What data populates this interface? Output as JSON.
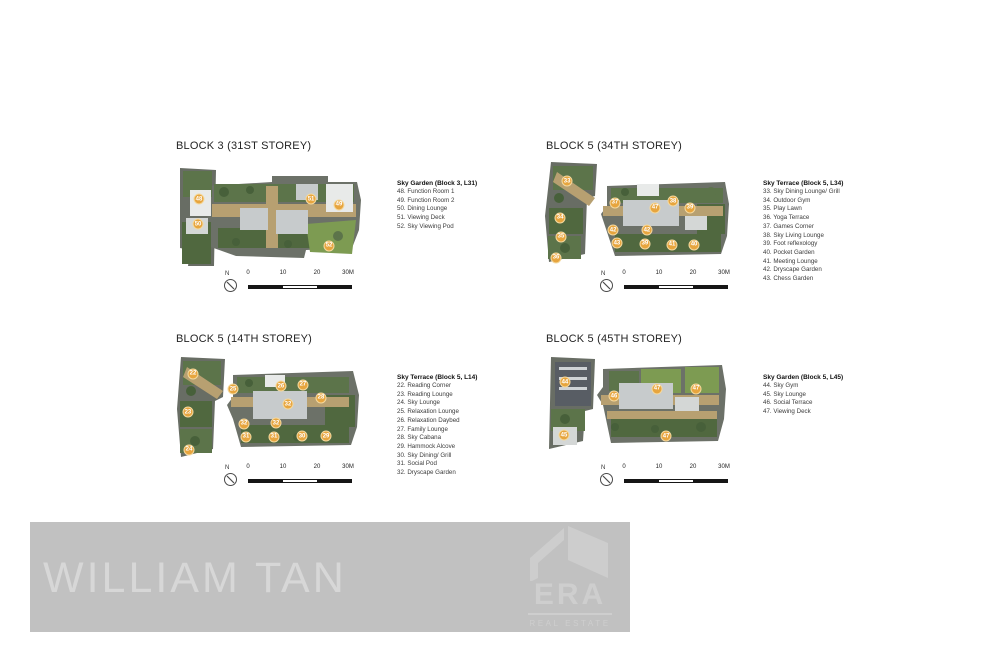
{
  "panels": [
    {
      "id": "block3-l31",
      "heading": "BLOCK 3 (31ST STOREY)",
      "legend_title": "Sky Garden (Block 3, L31)",
      "legend_items": [
        "48. Function Room 1",
        "49. Function Room 2",
        "50. Dining Lounge",
        "51. Viewing Deck",
        "52. Sky Viewing Pod"
      ],
      "markers": [
        {
          "label": "48",
          "x": 11.4,
          "y": 32.4
        },
        {
          "label": "50",
          "x": 10.9,
          "y": 56.9
        },
        {
          "label": "51",
          "x": 72.3,
          "y": 32.4
        },
        {
          "label": "49",
          "x": 87.5,
          "y": 38.2
        },
        {
          "label": "52",
          "x": 82.1,
          "y": 78.4
        }
      ]
    },
    {
      "id": "block5-l34",
      "heading": "BLOCK 5 (34TH STOREY)",
      "legend_title": "Sky Terrace (Block 5, L34)",
      "legend_items": [
        "33. Sky Dining Lounge/ Grill",
        "34. Outdoor Gym",
        "35. Play Lawn",
        "36. Yoga Terrace",
        "37. Games Corner",
        "38. Sky Living Lounge",
        "39. Foot reflexology",
        "40. Pocket Garden",
        "41. Meeting Lounge",
        "42. Dryscape Garden",
        "43. Chess Garden"
      ],
      "markers": [
        {
          "label": "33",
          "x": 12.0,
          "y": 18.3
        },
        {
          "label": "34",
          "x": 8.2,
          "y": 53.8
        },
        {
          "label": "35",
          "x": 8.7,
          "y": 72.1
        },
        {
          "label": "36",
          "x": 6.0,
          "y": 92.3
        },
        {
          "label": "37",
          "x": 38.0,
          "y": 39.4
        },
        {
          "label": "47",
          "x": 59.8,
          "y": 44.2
        },
        {
          "label": "38",
          "x": 69.6,
          "y": 37.5
        },
        {
          "label": "39",
          "x": 78.8,
          "y": 44.2
        },
        {
          "label": "42",
          "x": 37.0,
          "y": 65.4
        },
        {
          "label": "42",
          "x": 55.4,
          "y": 65.4
        },
        {
          "label": "43",
          "x": 39.1,
          "y": 77.9
        },
        {
          "label": "39",
          "x": 54.3,
          "y": 78.8
        },
        {
          "label": "41",
          "x": 69.0,
          "y": 79.8
        },
        {
          "label": "40",
          "x": 81.0,
          "y": 79.8
        }
      ]
    },
    {
      "id": "block5-l14",
      "heading": "BLOCK 5 (14TH STOREY)",
      "legend_title": "Sky Terrace (Block 5, L14)",
      "legend_items": [
        "22. Reading Corner",
        "23. Reading Lounge",
        "24. Sky Lounge",
        "25. Relaxation Lounge",
        "26. Relaxation Daybed",
        "27. Family Lounge",
        "28. Sky Cabana",
        "29. Hammock Alcove",
        "30. Sky Dining/ Grill",
        "31. Social Pod",
        "32. Dryscape Garden"
      ],
      "markers": [
        {
          "label": "22",
          "x": 8.8,
          "y": 16.3
        },
        {
          "label": "25",
          "x": 30.8,
          "y": 30.8
        },
        {
          "label": "26",
          "x": 57.1,
          "y": 27.9
        },
        {
          "label": "27",
          "x": 69.2,
          "y": 26.9
        },
        {
          "label": "28",
          "x": 79.1,
          "y": 39.4
        },
        {
          "label": "32",
          "x": 61.0,
          "y": 45.2
        },
        {
          "label": "23",
          "x": 6.0,
          "y": 52.9
        },
        {
          "label": "32",
          "x": 36.8,
          "y": 64.4
        },
        {
          "label": "32",
          "x": 54.4,
          "y": 63.5
        },
        {
          "label": "31",
          "x": 37.9,
          "y": 76.9
        },
        {
          "label": "31",
          "x": 53.3,
          "y": 76.9
        },
        {
          "label": "30",
          "x": 68.7,
          "y": 76.0
        },
        {
          "label": "29",
          "x": 81.9,
          "y": 76.0
        },
        {
          "label": "24",
          "x": 6.6,
          "y": 89.4
        }
      ]
    },
    {
      "id": "block5-l45",
      "heading": "BLOCK 5 (45TH STOREY)",
      "legend_title": "Sky Garden (Block 5, L45)",
      "legend_items": [
        "44. Sky Gym",
        "45. Sky Lounge",
        "46. Social Terrace",
        "47. Viewing Deck"
      ],
      "markers": [
        {
          "label": "44",
          "x": 11.0,
          "y": 25.3
        },
        {
          "label": "46",
          "x": 38.1,
          "y": 39.4
        },
        {
          "label": "47",
          "x": 61.9,
          "y": 32.3
        },
        {
          "label": "47",
          "x": 83.4,
          "y": 32.3
        },
        {
          "label": "45",
          "x": 10.5,
          "y": 78.8
        },
        {
          "label": "47",
          "x": 66.9,
          "y": 79.8
        }
      ]
    }
  ],
  "scale_bar": {
    "north": "N",
    "labels": [
      "0",
      "10",
      "20",
      "30M"
    ]
  },
  "watermark": {
    "agent_name": "WILLIAM TAN",
    "brand": "ERA",
    "brand_sub": "REAL ESTATE"
  },
  "colors": {
    "marker_fill": "#E7A53E",
    "marker_border": "#F4D99F",
    "banner_bg": "#c1c1c1",
    "banner_text": "#d7d7d7",
    "logo_gray": "#cecece"
  }
}
